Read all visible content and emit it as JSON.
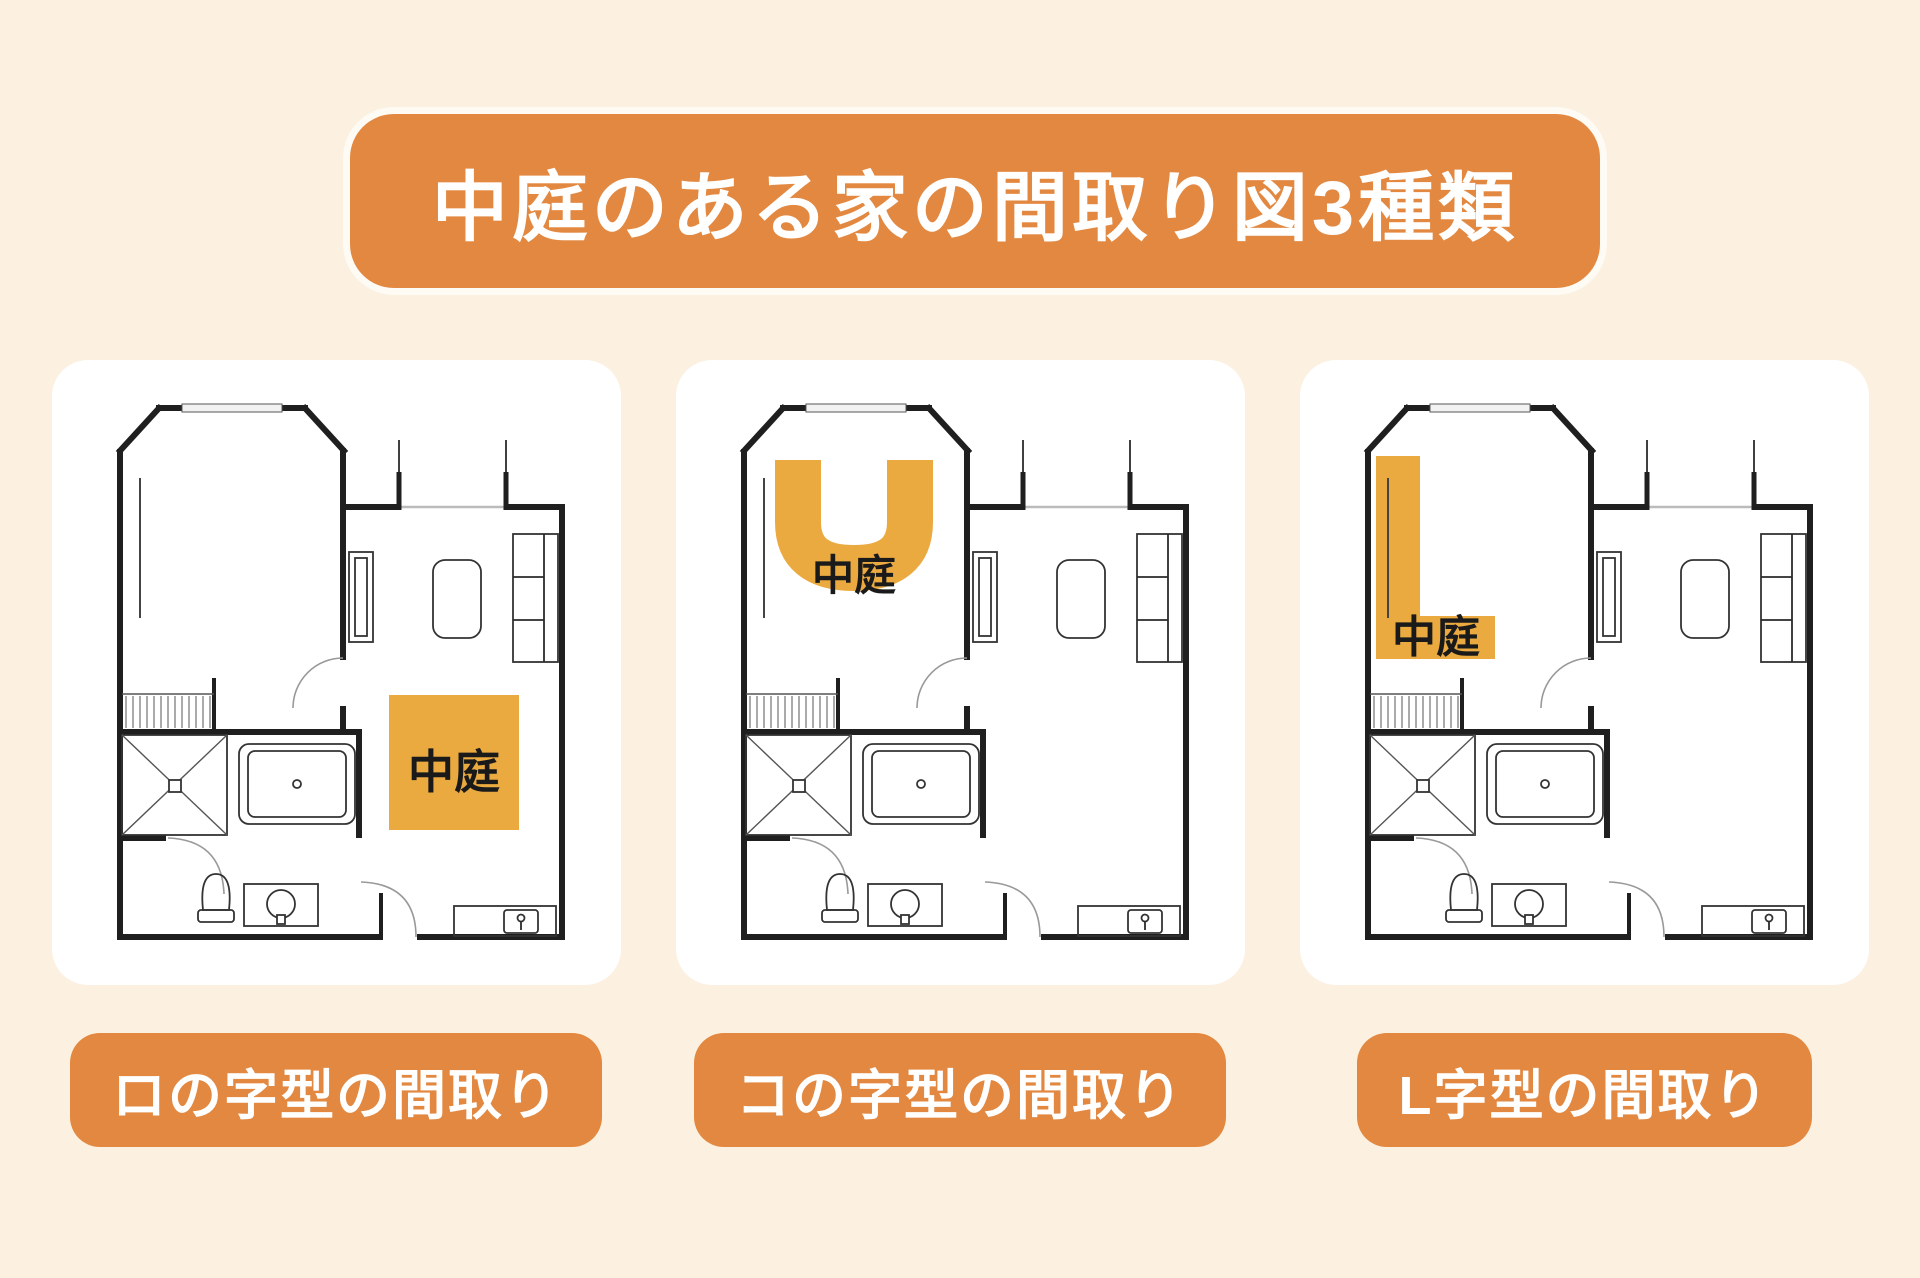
{
  "title": "中庭のある家の間取り図3種類",
  "colors": {
    "background": "#FCF0E0",
    "accent": "#E38840",
    "courtyard": "#EAAA40",
    "wall": "#1F1F1F",
    "card": "#FFFFFF",
    "courtyard_text": "#1A1A1A"
  },
  "cards": [
    {
      "courtyard_shape": "square",
      "courtyard_label": "中庭",
      "caption": "ロの字型の間取り"
    },
    {
      "courtyard_shape": "u",
      "courtyard_label": "中庭",
      "caption": "コの字型の間取り"
    },
    {
      "courtyard_shape": "l",
      "courtyard_label": "中庭",
      "caption": "L字型の間取り"
    }
  ]
}
